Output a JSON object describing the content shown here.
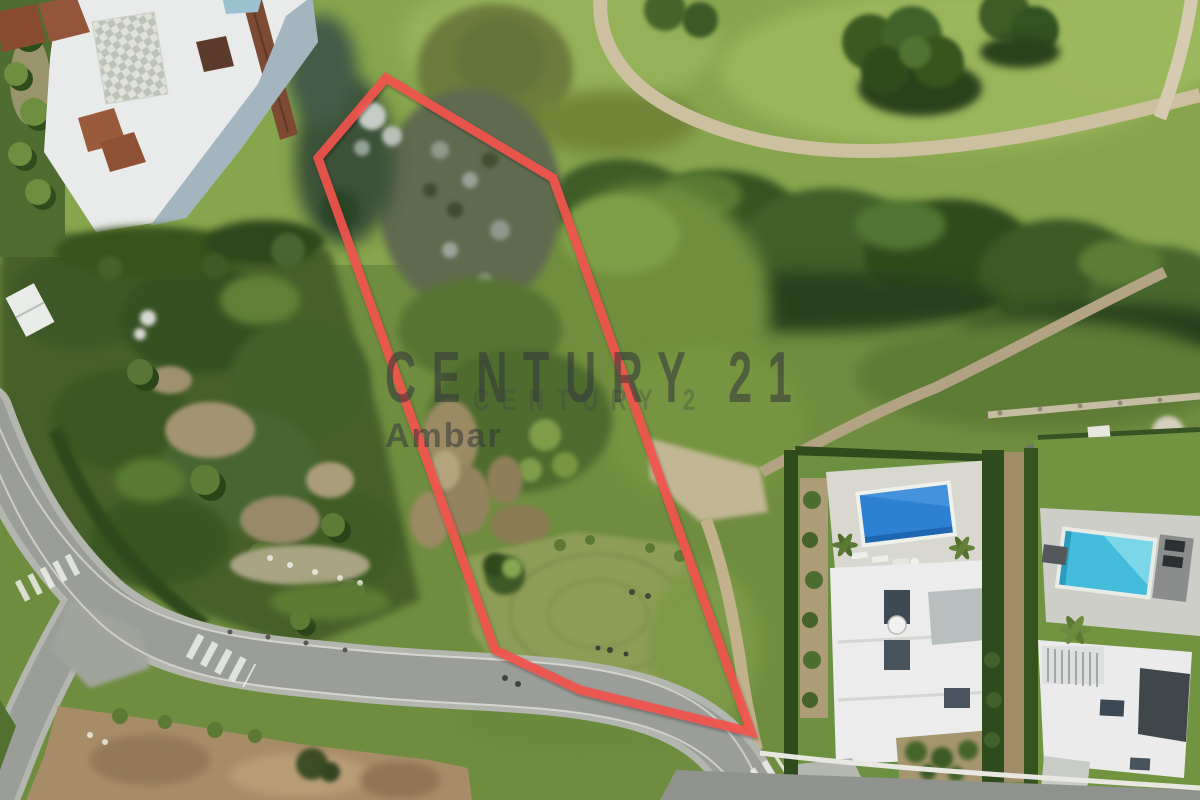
{
  "image": {
    "kind": "aerial-drone-photo",
    "subject": "Building plot for sale outlined in red between a golf course, an apartment complex and modern villas with pools",
    "width": 1200,
    "height": 800
  },
  "watermark": {
    "brand": "CENTURY 21",
    "brand_ghost": "CENTURY 2",
    "agency": "Ambar",
    "text_color": "#33373a"
  },
  "plot_outline": {
    "color": "#f2534c",
    "stroke_width": 9,
    "points": "318,158 386,78 553,178 751,732 580,690 495,650"
  },
  "palette": {
    "grass_bright": "#8ba94e",
    "grass_dark": "#3a5724",
    "scrub_rocky": "#5e6b50",
    "sand_path": "#ccc0a0",
    "road_asphalt": "#9b9e98",
    "dirt_field": "#a78c68",
    "building_white": "#ebecec",
    "roof_brown": "#8a4c31",
    "shadow_wall_blue": "#a3b6bf",
    "pool_blue": "#2e80d2",
    "pool_cyan": "#45bcdc",
    "outline_red": "#f2534c"
  }
}
